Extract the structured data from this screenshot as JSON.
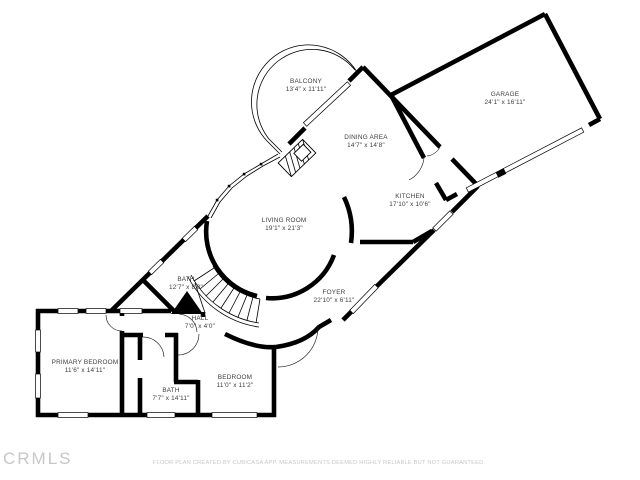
{
  "plan": {
    "rooms": [
      {
        "name": "BALCONY",
        "dims": "13'4\" x 11'11\""
      },
      {
        "name": "GARAGE",
        "dims": "24'1\" x 16'11\""
      },
      {
        "name": "DINING AREA",
        "dims": "14'7\" x 14'8\""
      },
      {
        "name": "KITCHEN",
        "dims": "17'10\" x 10'6\""
      },
      {
        "name": "LIVING ROOM",
        "dims": "19'1\" x 21'3\""
      },
      {
        "name": "FOYER",
        "dims": "22'10\" x 6'11\""
      },
      {
        "name": "BATH",
        "dims": "12'7\" x 8'0\""
      },
      {
        "name": "HALL",
        "dims": "7'0\" x 4'0\""
      },
      {
        "name": "PRIMARY BEDROOM",
        "dims": "11'6\" x 14'11\""
      },
      {
        "name": "BATH",
        "dims": "7'7\" x 14'11\""
      },
      {
        "name": "BEDROOM",
        "dims": "11'0\" x 11'2\""
      }
    ],
    "footer": {
      "logo": "CRMLS",
      "disclaimer": "FLOOR PLAN CREATED BY CUBICASA APP. MEASUREMENTS DEEMED HIGHLY RELIABLE BUT NOT GUARANTEED."
    },
    "colors": {
      "wall": "#000000",
      "background": "#ffffff",
      "label_text": "#3d3d3d",
      "watermark": "#c7c7c7"
    }
  }
}
